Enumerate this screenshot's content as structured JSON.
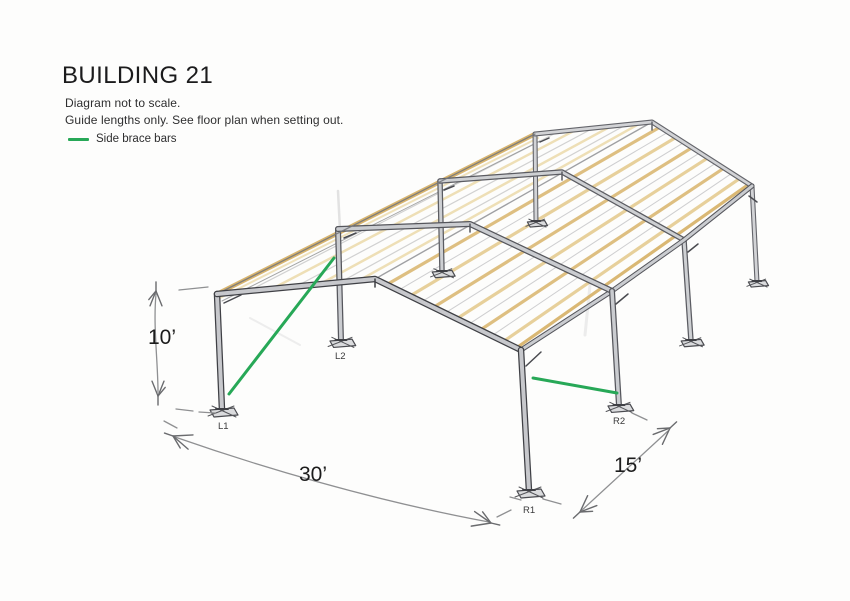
{
  "header": {
    "title": "BUILDING 21",
    "note_line1": "Diagram not to scale.",
    "note_line2": "Guide lengths only. See floor plan when setting out."
  },
  "legend": {
    "items": [
      {
        "label": "Side brace bars",
        "swatch_color": "#27a857"
      }
    ]
  },
  "diagram": {
    "type": "hand-drawn perspective sketch of a steel portal-frame building",
    "dimensions": {
      "height": "10’",
      "width": "30’",
      "depth": "15’"
    },
    "column_labels": {
      "l1": "L1",
      "l2": "L2",
      "r1": "R1",
      "r2": "R2"
    },
    "colors": {
      "brace_green": "#27a857",
      "purlin_tan": "#dcbc7a",
      "purlin_tan_light": "#ecdcae",
      "eave_tan": "#d8b46d",
      "steel_fill": "#c7c8cc",
      "ink": "#46474d",
      "pencil_dim": "#8f9092",
      "text": "#1c1c1c",
      "label": "#3a3a3b"
    }
  }
}
